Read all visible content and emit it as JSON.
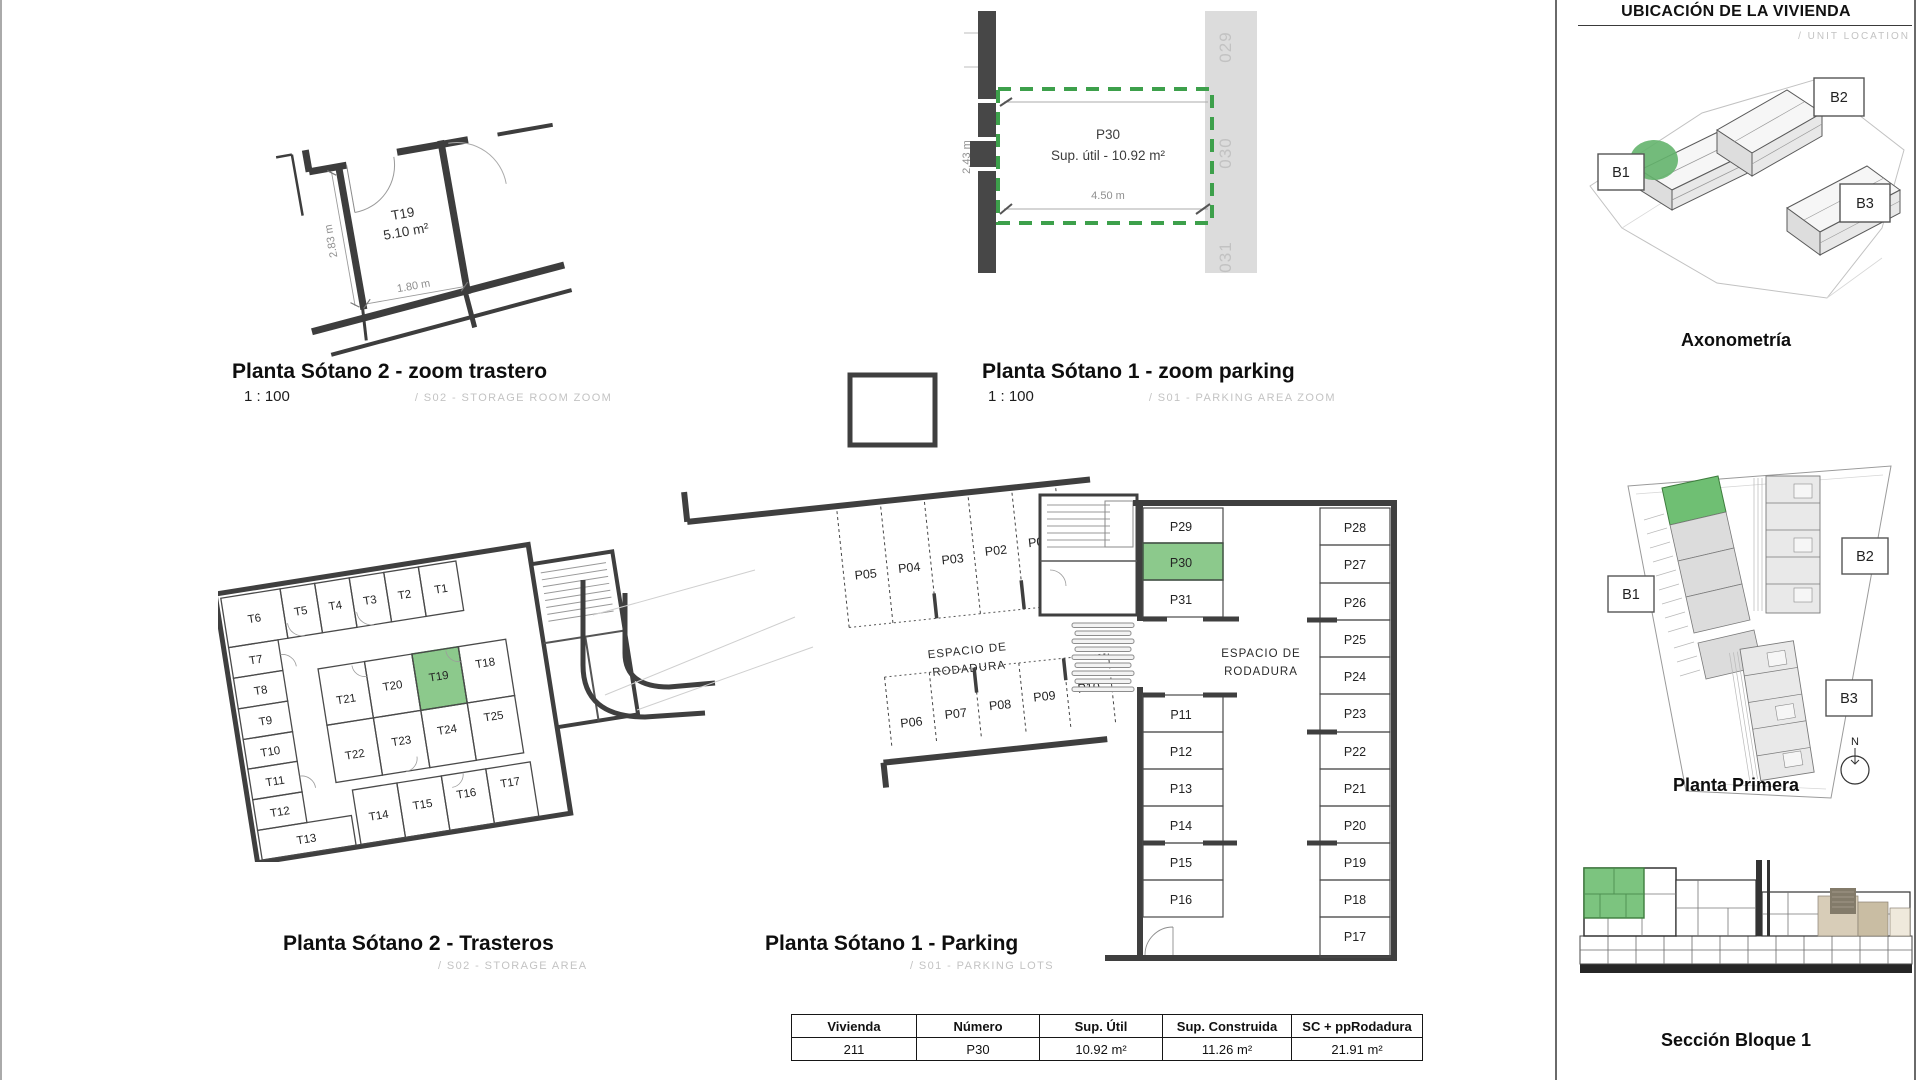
{
  "page": {
    "green": "#8cc98c",
    "green_border": "#3c8a46",
    "dash_green": "#3da04b",
    "wall": "#3f3f3f"
  },
  "sidebar": {
    "title": "UBICACIÓN DE LA VIVIENDA",
    "subtitle": "/ UNIT LOCATION",
    "axonometria": {
      "title": "Axonometría",
      "b1": "B1",
      "b2": "B2",
      "b3": "B3"
    },
    "planta_primera": {
      "title": "Planta Primera",
      "b1": "B1",
      "b2": "B2",
      "b3": "B3",
      "north": "N"
    },
    "seccion": {
      "title": "Sección Bloque 1"
    }
  },
  "details": {
    "trastero": {
      "title": "Planta Sótano 2 - zoom trastero",
      "scale": "1 : 100",
      "code": "/ S02 - STORAGE ROOM ZOOM",
      "unit": "T19",
      "area": "5.10 m²",
      "width": "1.80 m",
      "height": "2.83 m"
    },
    "parking": {
      "title": "Planta Sótano 1 - zoom parking",
      "scale": "1 : 100",
      "code": "/ S01 - PARKING AREA ZOOM",
      "unit": "P30",
      "area": "Sup. útil - 10.92 m²",
      "width": "4.50 m",
      "height": "2.43 m",
      "neighbors": [
        "029",
        "030",
        "031"
      ]
    }
  },
  "plans": {
    "trasteros": {
      "title": "Planta Sótano 2 - Trasteros",
      "code": "/ S02 - STORAGE AREA",
      "top": [
        "T6",
        "T5",
        "T4",
        "T3",
        "T2",
        "T1"
      ],
      "left": [
        "T7",
        "T8",
        "T9",
        "T10",
        "T11",
        "T12",
        "T13"
      ],
      "inner_top": [
        "T21",
        "T20",
        "T19",
        "T18"
      ],
      "inner_bottom": [
        "T22",
        "T23",
        "T24",
        "T25"
      ],
      "bottom": [
        "T14",
        "T15",
        "T16",
        "T17"
      ],
      "highlight": "T19"
    },
    "parking": {
      "title": "Planta Sótano 1 - Parking",
      "code": "/ S01 - PARKING LOTS",
      "roadway1": "ESPACIO DE",
      "roadway2": "RODADURA",
      "row_top": [
        "P05",
        "P04",
        "P03",
        "P02",
        "P01"
      ],
      "row_bottom": [
        "P06",
        "P07",
        "P08",
        "P09",
        "P10"
      ],
      "col_mid_top": [
        "P29",
        "P30",
        "P31"
      ],
      "col_mid_bottom": [
        "P11",
        "P12",
        "P13",
        "P14",
        "P15",
        "P16"
      ],
      "col_right": [
        "P28",
        "P27",
        "P26",
        "P25",
        "P24",
        "P23",
        "P22",
        "P21",
        "P20",
        "P19",
        "P18",
        "P17"
      ],
      "highlight": "P30"
    }
  },
  "table": {
    "headers": [
      "Vivienda",
      "Número",
      "Sup. Útil",
      "Sup. Construida",
      "SC + ppRodadura"
    ],
    "row": [
      "211",
      "P30",
      "10.92 m²",
      "11.26 m²",
      "21.91 m²"
    ]
  }
}
